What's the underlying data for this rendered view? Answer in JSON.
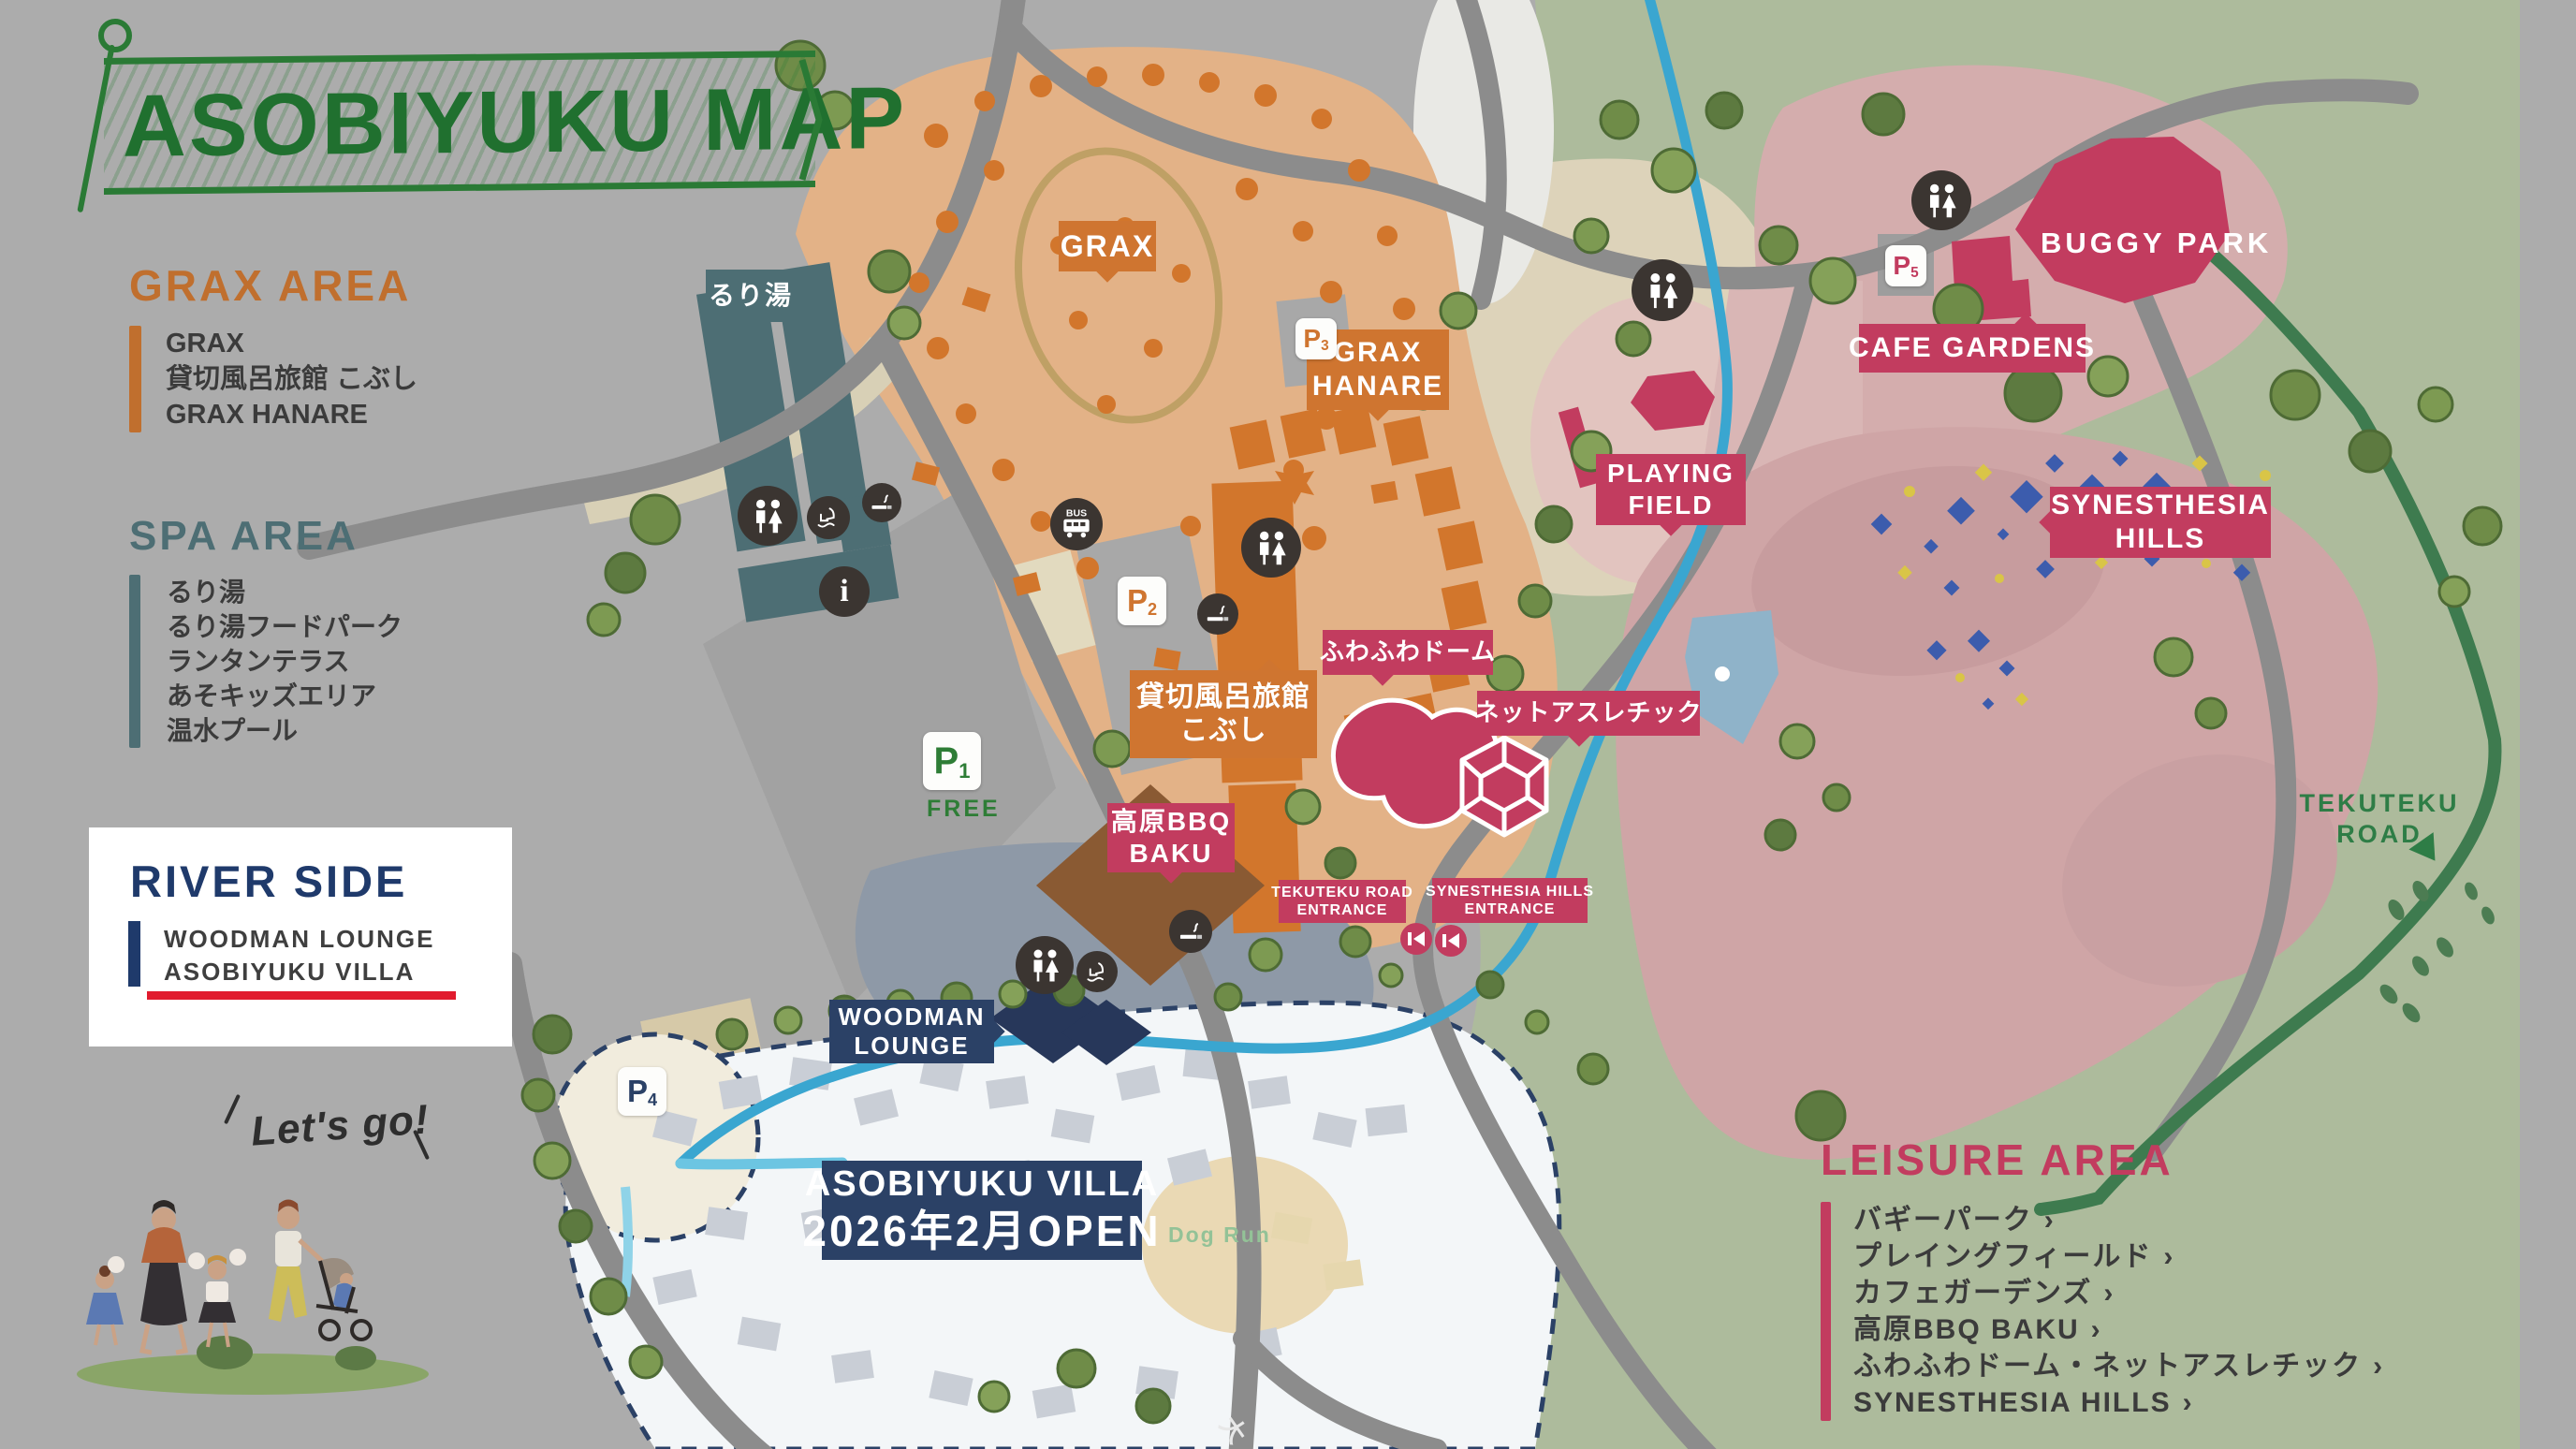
{
  "title": "ASOBIYUKU MAP",
  "legend": {
    "grax_area": {
      "heading": "GRAX AREA",
      "items": [
        "GRAX",
        "貸切風呂旅館 こぶし",
        "GRAX HANARE"
      ]
    },
    "spa_area": {
      "heading": "SPA AREA",
      "items": [
        "るり湯",
        "るり湯フードパーク",
        "ランタンテラス",
        "あそキッズエリア",
        "温水プール"
      ]
    },
    "river_side": {
      "heading": "RIVER SIDE",
      "items": [
        "WOODMAN LOUNGE",
        "ASOBIYUKU VILLA"
      ]
    },
    "leisure_area": {
      "heading": "LEISURE AREA",
      "chevron": "›",
      "items": [
        "バギーパーク",
        "プレイングフィールド",
        "カフェガーデンズ",
        "高原BBQ BAKU",
        "ふわふわドーム・ネットアスレチック",
        "SYNESTHESIA HILLS"
      ]
    }
  },
  "map_labels": {
    "ruriyu": "るり湯",
    "grax": "GRAX",
    "grax_hanare": [
      "GRAX",
      "HANARE"
    ],
    "kobushi": [
      "貸切風呂旅館",
      "こぶし"
    ],
    "fuwafuwa_dome": "ふわふわドーム",
    "net_athletic": "ネットアスレチック",
    "playing_field": [
      "PLAYING",
      "FIELD"
    ],
    "cafe_gardens": "CAFE GARDENS",
    "buggy_park": "BUGGY PARK",
    "synesthesia_hills": [
      "SYNESTHESIA",
      "HILLS"
    ],
    "tekuteku_entrance": [
      "TEKUTEKU ROAD",
      "ENTRANCE"
    ],
    "synesthesia_entrance": [
      "SYNESTHESIA HILLS",
      "ENTRANCE"
    ],
    "bbq_baku": [
      "高原BBQ",
      "BAKU"
    ],
    "woodman_lounge": [
      "WOODMAN",
      "LOUNGE"
    ],
    "asobiyuku_villa": [
      "ASOBIYUKU VILLA",
      "2026年2月OPEN"
    ],
    "tekuteku_road": [
      "TEKUTEKU",
      "ROAD"
    ],
    "dog_run": "Dog Run",
    "lets_go": "Let's go!",
    "road_name": "大"
  },
  "parking": [
    {
      "label": "P",
      "sub": "1",
      "note": "FREE",
      "color": "#2e7d36"
    },
    {
      "label": "P",
      "sub": "2",
      "color": "#cf7530"
    },
    {
      "label": "P",
      "sub": "3",
      "color": "#cf7530"
    },
    {
      "label": "P",
      "sub": "4",
      "color": "#2b4166"
    },
    {
      "label": "P",
      "sub": "5",
      "color": "#c23c5f"
    }
  ],
  "icons": {
    "bus_label": "BUS",
    "info_label": "i"
  },
  "colors": {
    "grax_orange": "#cf7530",
    "spa_teal": "#4d6e74",
    "riverside_navy": "#2b4166",
    "leisure_crimson": "#c23c5f",
    "map_green": "#2a7a35",
    "river_blue": "#3aa6d0",
    "highlight_red": "#e11b2e",
    "background_gray": "#acacac",
    "sage_green": "#adbb9c"
  }
}
